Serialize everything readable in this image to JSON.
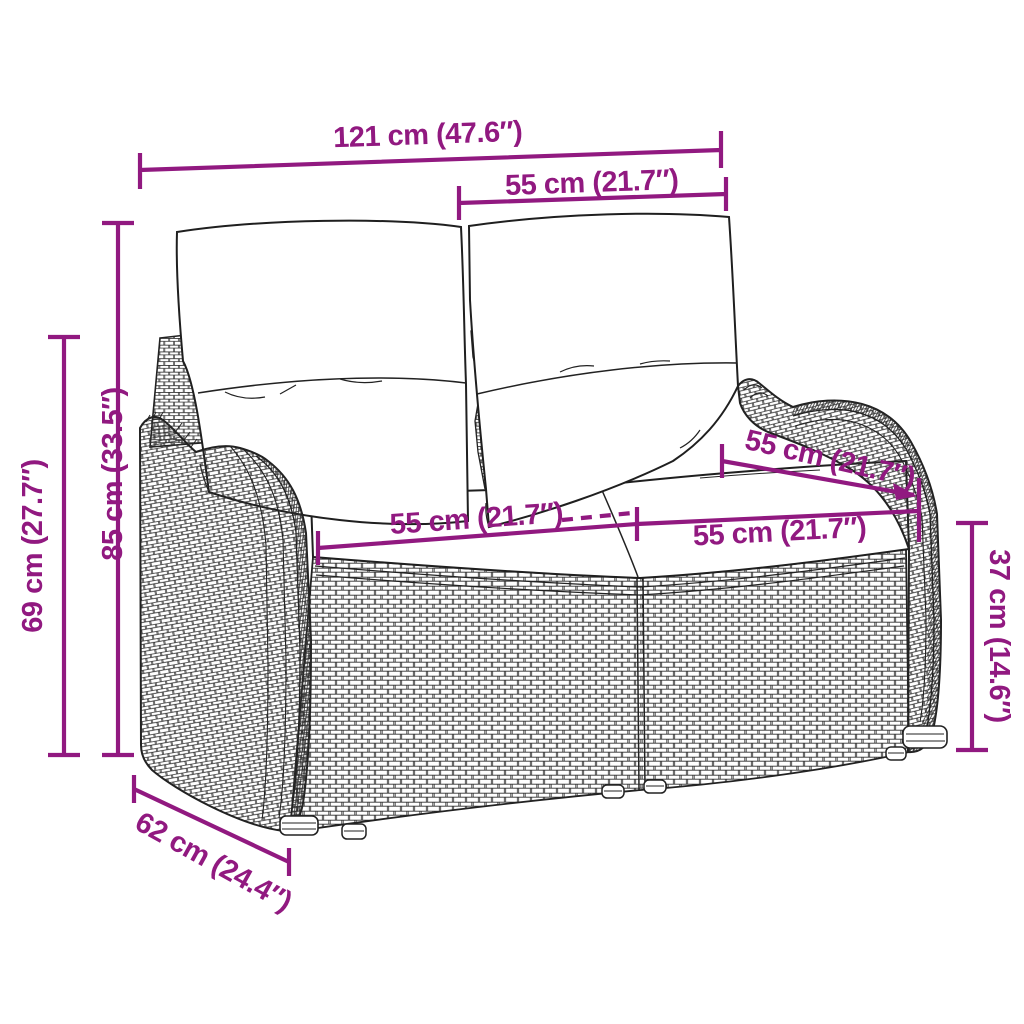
{
  "diagram": {
    "type": "product-dimension-diagram",
    "dims": {
      "total_width": "121 cm (47.6″)",
      "backrest_width": "55 cm (21.7″)",
      "total_height": "85 cm (33.5″)",
      "armrest_height": "69 cm (27.7″)",
      "seat_width_left": "55 cm (21.7″)",
      "seat_depth": "55 cm (21.7″)",
      "seat_width_right": "55 cm (21.7″)",
      "seat_height": "37 cm (14.6″)",
      "total_depth": "62 cm (24.4″)"
    },
    "colors": {
      "annotation": "#911980",
      "line_art": "#222222",
      "background": "#ffffff",
      "cushion_fill": "#ffffff"
    }
  }
}
